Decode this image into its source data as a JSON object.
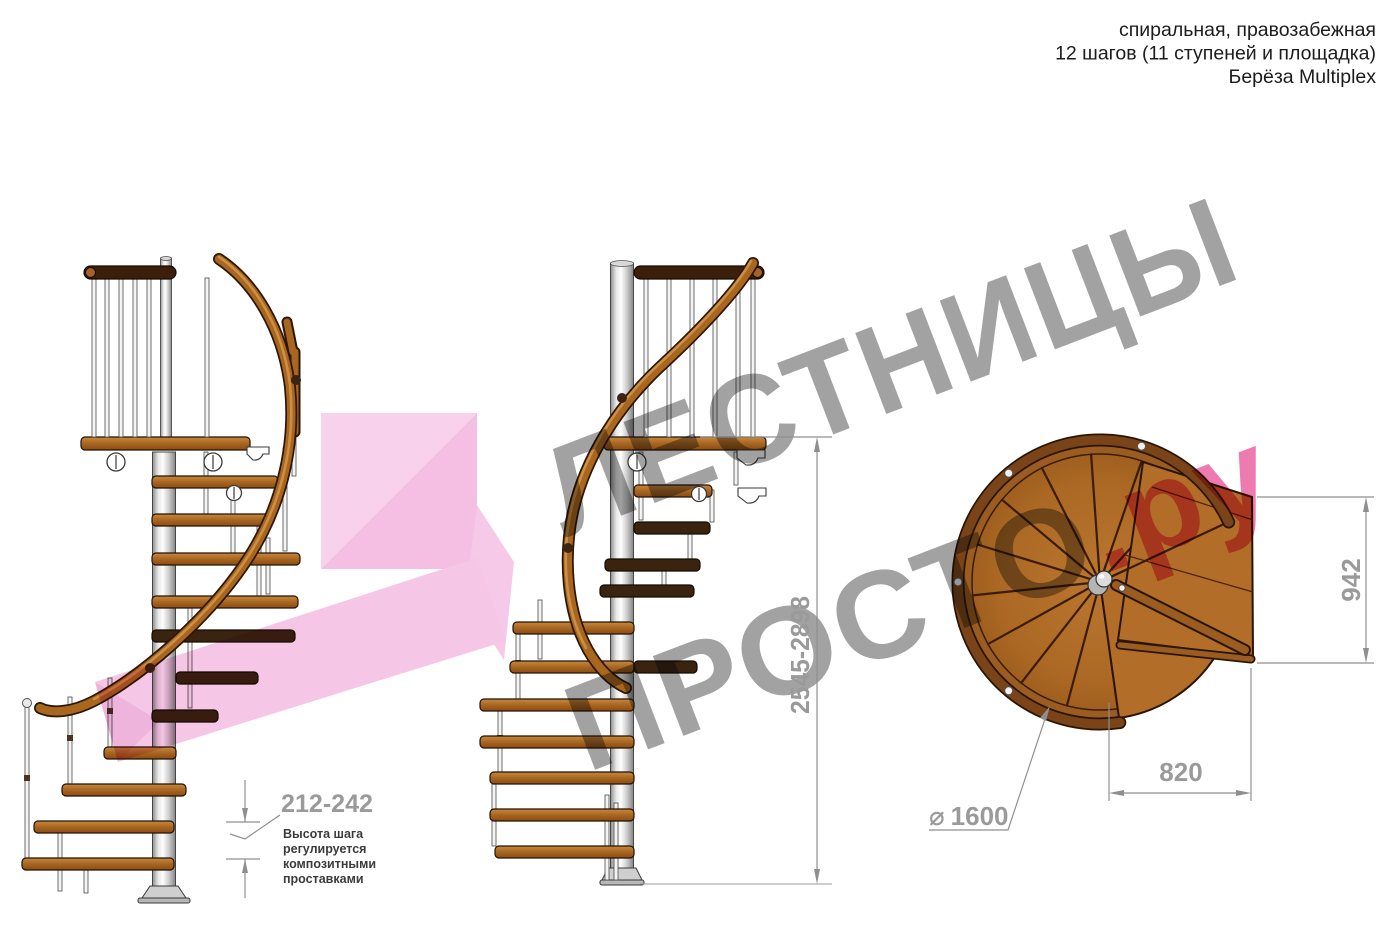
{
  "header": {
    "line1": "спиральная, правозабежная",
    "line2": "12 шагов (11 ступеней и площадка)",
    "line3": "Берёза Multiplex"
  },
  "watermark": {
    "line1": "ЛЕСТНИЦЫ",
    "line2_gray": "ПРОСТО",
    "line2_pink": ".ру",
    "gray_color": "#9d9d9d",
    "pink_color": "#ec74ab"
  },
  "dimensions": {
    "step_height": {
      "value": "212-242",
      "note_lines": [
        "Высота шага",
        "регулируется",
        "композитными",
        "проставками"
      ]
    },
    "total_height": {
      "value": "2545-2898"
    },
    "landing_depth": {
      "value": "942"
    },
    "landing_width": {
      "value": "820"
    },
    "diameter": {
      "symbol": "⌀",
      "value": "1600"
    }
  },
  "colors": {
    "wood": "#a9661f",
    "wood_dark": "#3a2410",
    "handrail": "#a8661f",
    "pole": "#d9d9d9",
    "watermark_pink": "#f3b4de",
    "dimension_gray": "#9a9a9a"
  }
}
